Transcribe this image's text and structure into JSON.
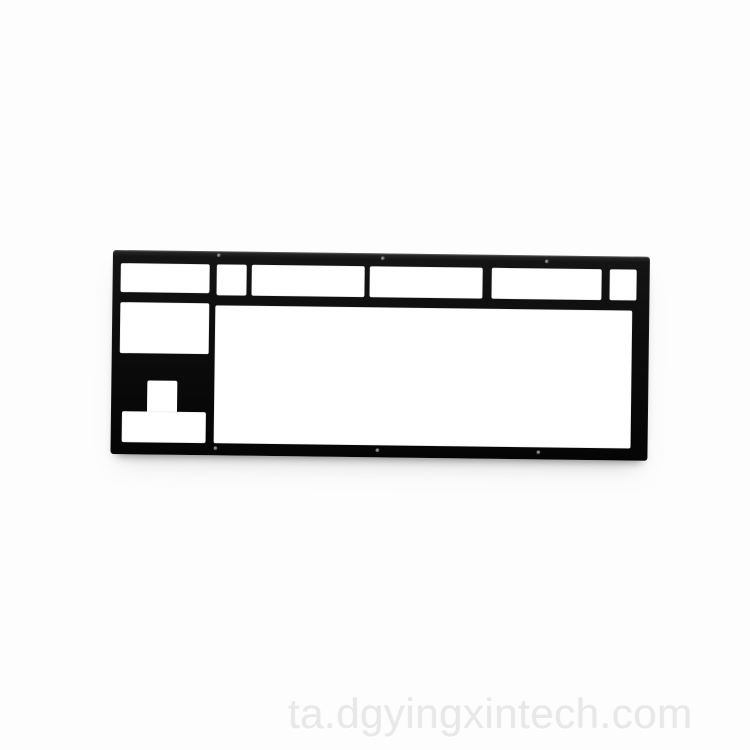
{
  "photo": {
    "subject": "black keyboard mounting plate on white seamless background",
    "background_color": "#fdfdfd",
    "plate_color": "#0c0c0c",
    "cutout_color": "#ffffff",
    "screw_hole_count": 6
  },
  "watermark": {
    "text": "ta.dgyingxintech.com",
    "color": "#e8e8e8"
  }
}
